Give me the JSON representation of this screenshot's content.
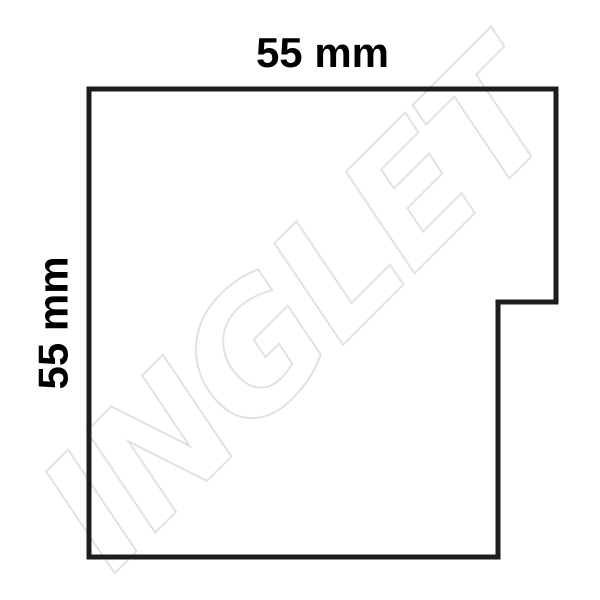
{
  "background": "#ffffff",
  "watermark": {
    "text": "INGLET",
    "color": "#e8dee6"
  },
  "shape": {
    "points": "89,89 556,89 556,302 498,302 498,557 89,557",
    "stroke_color": "#1d1d1b",
    "stroke_width": "5"
  },
  "dimensions": {
    "top": "55 mm",
    "left": "55 mm",
    "text_color": "#000000"
  }
}
